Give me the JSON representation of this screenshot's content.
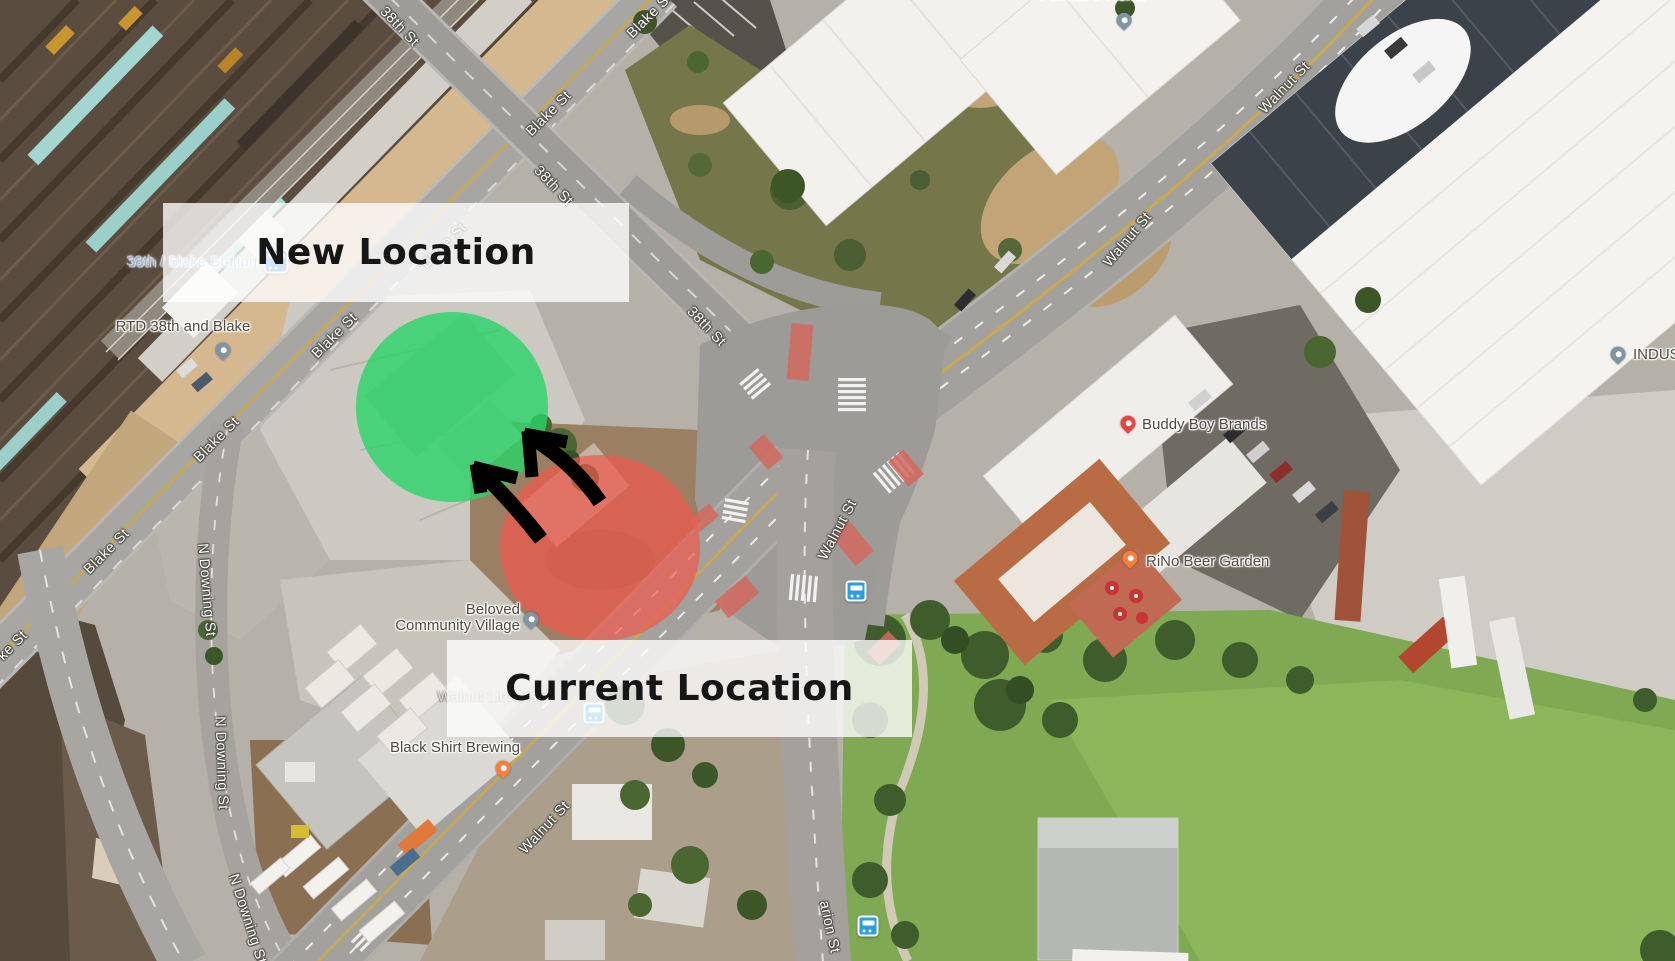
{
  "annotations": {
    "new_location": {
      "label": "New Location"
    },
    "current_location": {
      "label": "Current Location"
    },
    "overlay_bg": "rgba(255,255,255,0.78)",
    "overlay_text_color": "#161616",
    "new_circle_color": "rgba(40,213,104,0.8)",
    "current_circle_color": "rgba(239,90,78,0.72)",
    "arrow_color": "#000000"
  },
  "street_labels": [
    {
      "text": "38th St"
    },
    {
      "text": "Blake St"
    },
    {
      "text": "Blake St"
    },
    {
      "text": "38th St"
    },
    {
      "text": "Blake St"
    },
    {
      "text": "Blake St"
    },
    {
      "text": "38th St"
    },
    {
      "text": "Blake St"
    },
    {
      "text": "Blake St"
    },
    {
      "text": "ke St"
    },
    {
      "text": "Walnut St"
    },
    {
      "text": "Walnut St"
    },
    {
      "text": "Walnut St"
    },
    {
      "text": "Walnut St"
    },
    {
      "text": "N Downing St"
    },
    {
      "text": "N Downing St"
    },
    {
      "text": "N Downing St"
    },
    {
      "text": "arion St"
    }
  ],
  "pois": {
    "station": {
      "name": "38th / Blake Station",
      "icon": "train-badge",
      "icon_color": "#4285f4",
      "text_color": "#93afd6"
    },
    "rtd": {
      "name": "RTD 38th and Blake",
      "icon": "map-pin",
      "pin_color": "#7f95a3"
    },
    "furniture_works": {
      "name": "Furniture Works",
      "icon": "map-pin",
      "pin_color": "#7f95a3"
    },
    "industry": {
      "name": "INDUS",
      "icon": "map-pin",
      "pin_color": "#7f95a3"
    },
    "buddy_boy": {
      "name": "Buddy Boy Brands",
      "icon": "shopping-pin",
      "pin_color": "#e8453c"
    },
    "rino_beer_garden": {
      "name": "RiNo Beer Garden",
      "icon": "restaurant-pin",
      "pin_color": "#f5803e"
    },
    "beloved": {
      "line1": "Beloved",
      "line2": "Community Village",
      "icon": "map-pin",
      "pin_color": "#7f95a3"
    },
    "walnut_liquors": {
      "name": "Walnut Liquors"
    },
    "black_shirt_brewing": {
      "name": "Black Shirt Brewing",
      "icon": "restaurant-pin",
      "pin_color": "#f5803e"
    }
  },
  "transit_stops": {
    "icon": "bus-badge",
    "icon_color": "#2b9de0"
  }
}
